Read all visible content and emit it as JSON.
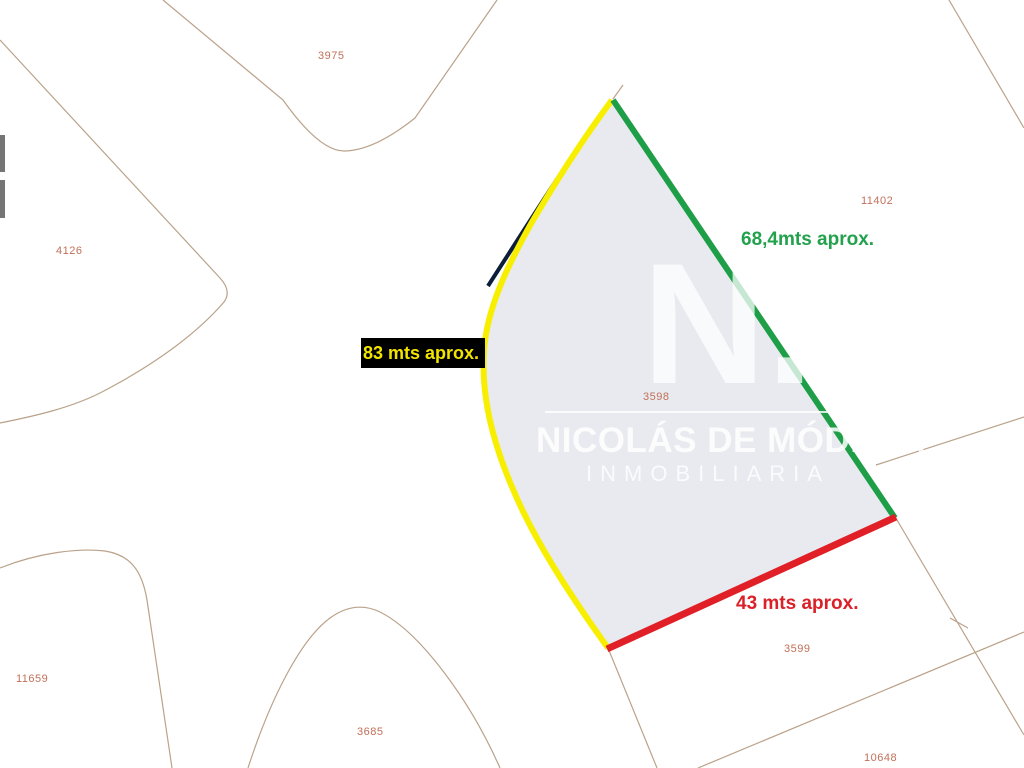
{
  "map": {
    "watermark": {
      "monogram": "N.",
      "name": "NICOLÁS DE MÓDENA",
      "subtitle": "INMOBILIARIA"
    },
    "measurements": {
      "left_side": {
        "label": "83 mts aprox.",
        "text_color": "#f2e400",
        "bg_color": "#000000"
      },
      "right_side": {
        "label": "68,4mts aprox.",
        "text_color": "#23a14c"
      },
      "bottom_side": {
        "label": "43 mts aprox.",
        "text_color": "#da2128"
      }
    },
    "highlight_colors": {
      "parcel_fill": "#e8eaef",
      "yellow_boundary": "#f8ef00",
      "green_boundary": "#1f9e48",
      "red_boundary": "#e01f26",
      "cadastral_navy": "#0c1d3a",
      "boundary_line": "#b3987d"
    },
    "parcels": {
      "p3975": "3975",
      "p4126": "4126",
      "p11402": "11402",
      "p3598": "3598",
      "p3599": "3599",
      "p11659": "11659",
      "p3685": "3685",
      "p10648": "10648"
    }
  }
}
